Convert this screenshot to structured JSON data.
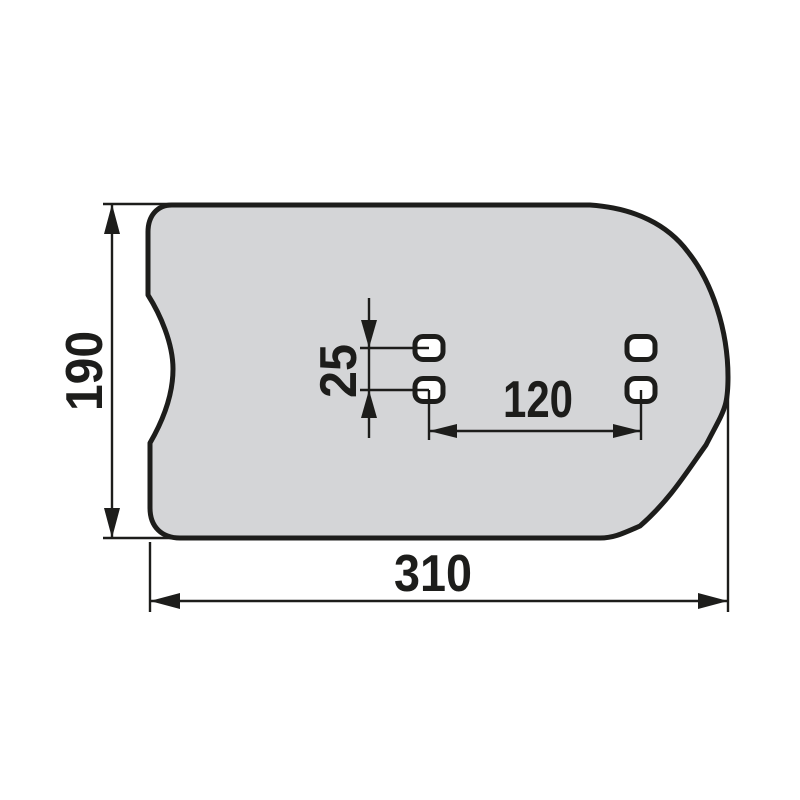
{
  "background_color": "#ffffff",
  "line_color": "#1d1d1b",
  "part": {
    "fill_color": "#d4d5d7",
    "hole_fill_color": "#ffffff",
    "hole_count": "4"
  },
  "dimensions": {
    "overall_height": "190",
    "overall_width": "310",
    "hole_pitch_horizontal": "120",
    "hole_pitch_vertical": "25"
  }
}
